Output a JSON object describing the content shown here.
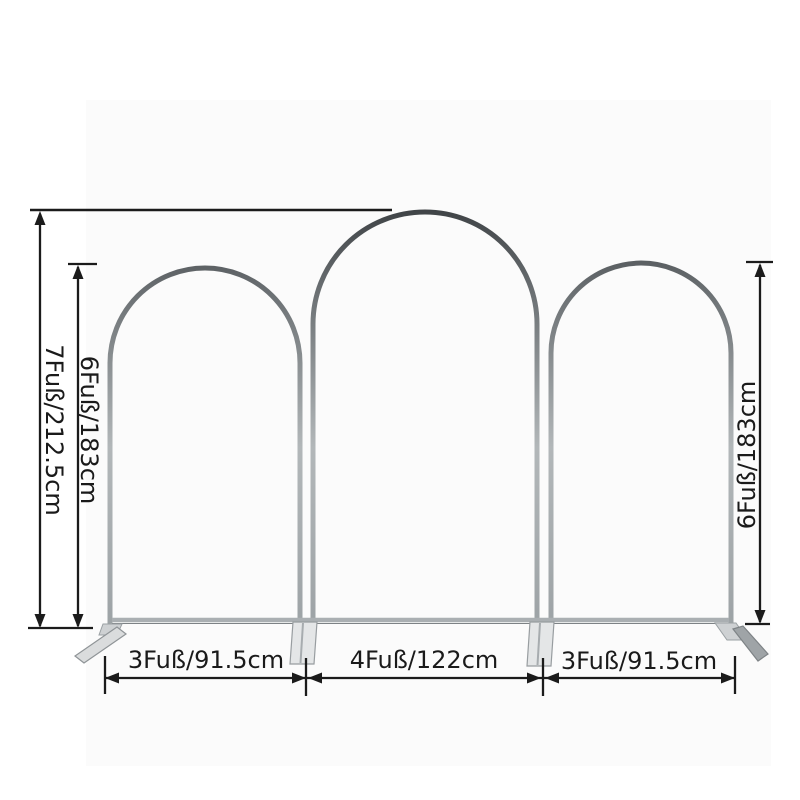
{
  "diagram": {
    "subject": "arch-backdrop-stand-set",
    "labels": {
      "total_height": "7Fuß/212.5cm",
      "left_arch_height": "6Fuß/183cm",
      "right_arch_height": "6Fuß/183cm",
      "left_arch_width": "3Fuß/91.5cm",
      "middle_arch_width": "4Fuß/122cm",
      "right_arch_width": "3Fuß/91.5cm"
    },
    "colors": {
      "background": "#ffffff",
      "photo_background": "#fbfbfb",
      "frame_dark": "#3e4245",
      "frame_light": "#b2b7b9",
      "foot_fill": "#dfe1e2",
      "dimension_line": "#1b1b1b"
    }
  }
}
